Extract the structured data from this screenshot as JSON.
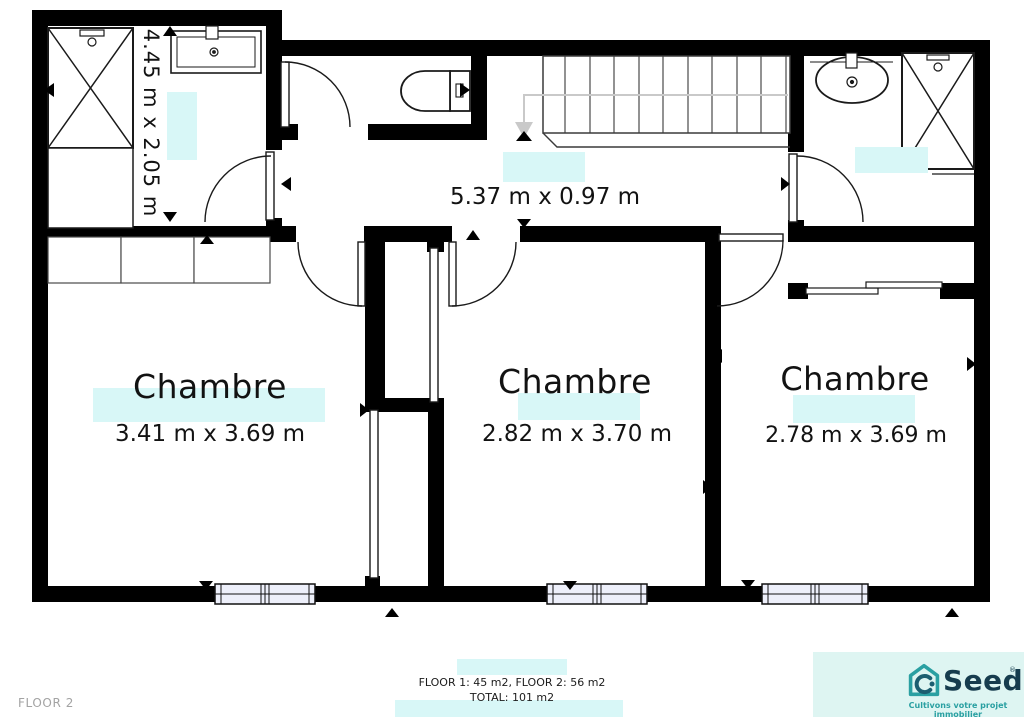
{
  "floor_label": "FLOOR 2",
  "rooms": [
    {
      "name": "Chambre",
      "dims": "3.41 m x 3.69 m"
    },
    {
      "name": "Chambre",
      "dims": "2.82 m x 3.70 m"
    },
    {
      "name": "Chambre",
      "dims": "2.78 m x 3.69 m"
    }
  ],
  "hallway": {
    "dims": "5.37 m x 0.97 m"
  },
  "bathroom_left": {
    "dims": "4.45 m x 2.05 m"
  },
  "footer": {
    "line1": "FLOOR 1: 45 m2, FLOOR 2: 56 m2",
    "line2": "TOTAL: 101 m2"
  },
  "brand": {
    "name": "Seeds",
    "trademark": "®",
    "tagline": "Cultivons votre projet immobilier"
  },
  "icons": {
    "shower": "crossed-square",
    "sink": "basin-with-faucet",
    "toilet": "bowl-with-tank",
    "stairs": "parallel-treads",
    "door": "quarter-arc-swing",
    "window": "double-sash-in-wall"
  },
  "colors": {
    "highlight": "#d8f7f7",
    "wall": "#000000",
    "line": "#2a2a2a",
    "window_fill": "#edeffa",
    "stair_arrow_gray": "#c9c9c9",
    "floor_label_gray": "#a3a3a3",
    "brand_teal": "#2aa0a2",
    "brand_dark": "#163c4e",
    "brand_swirl": "#1c5e70",
    "brand_bg": "#def5f2"
  }
}
